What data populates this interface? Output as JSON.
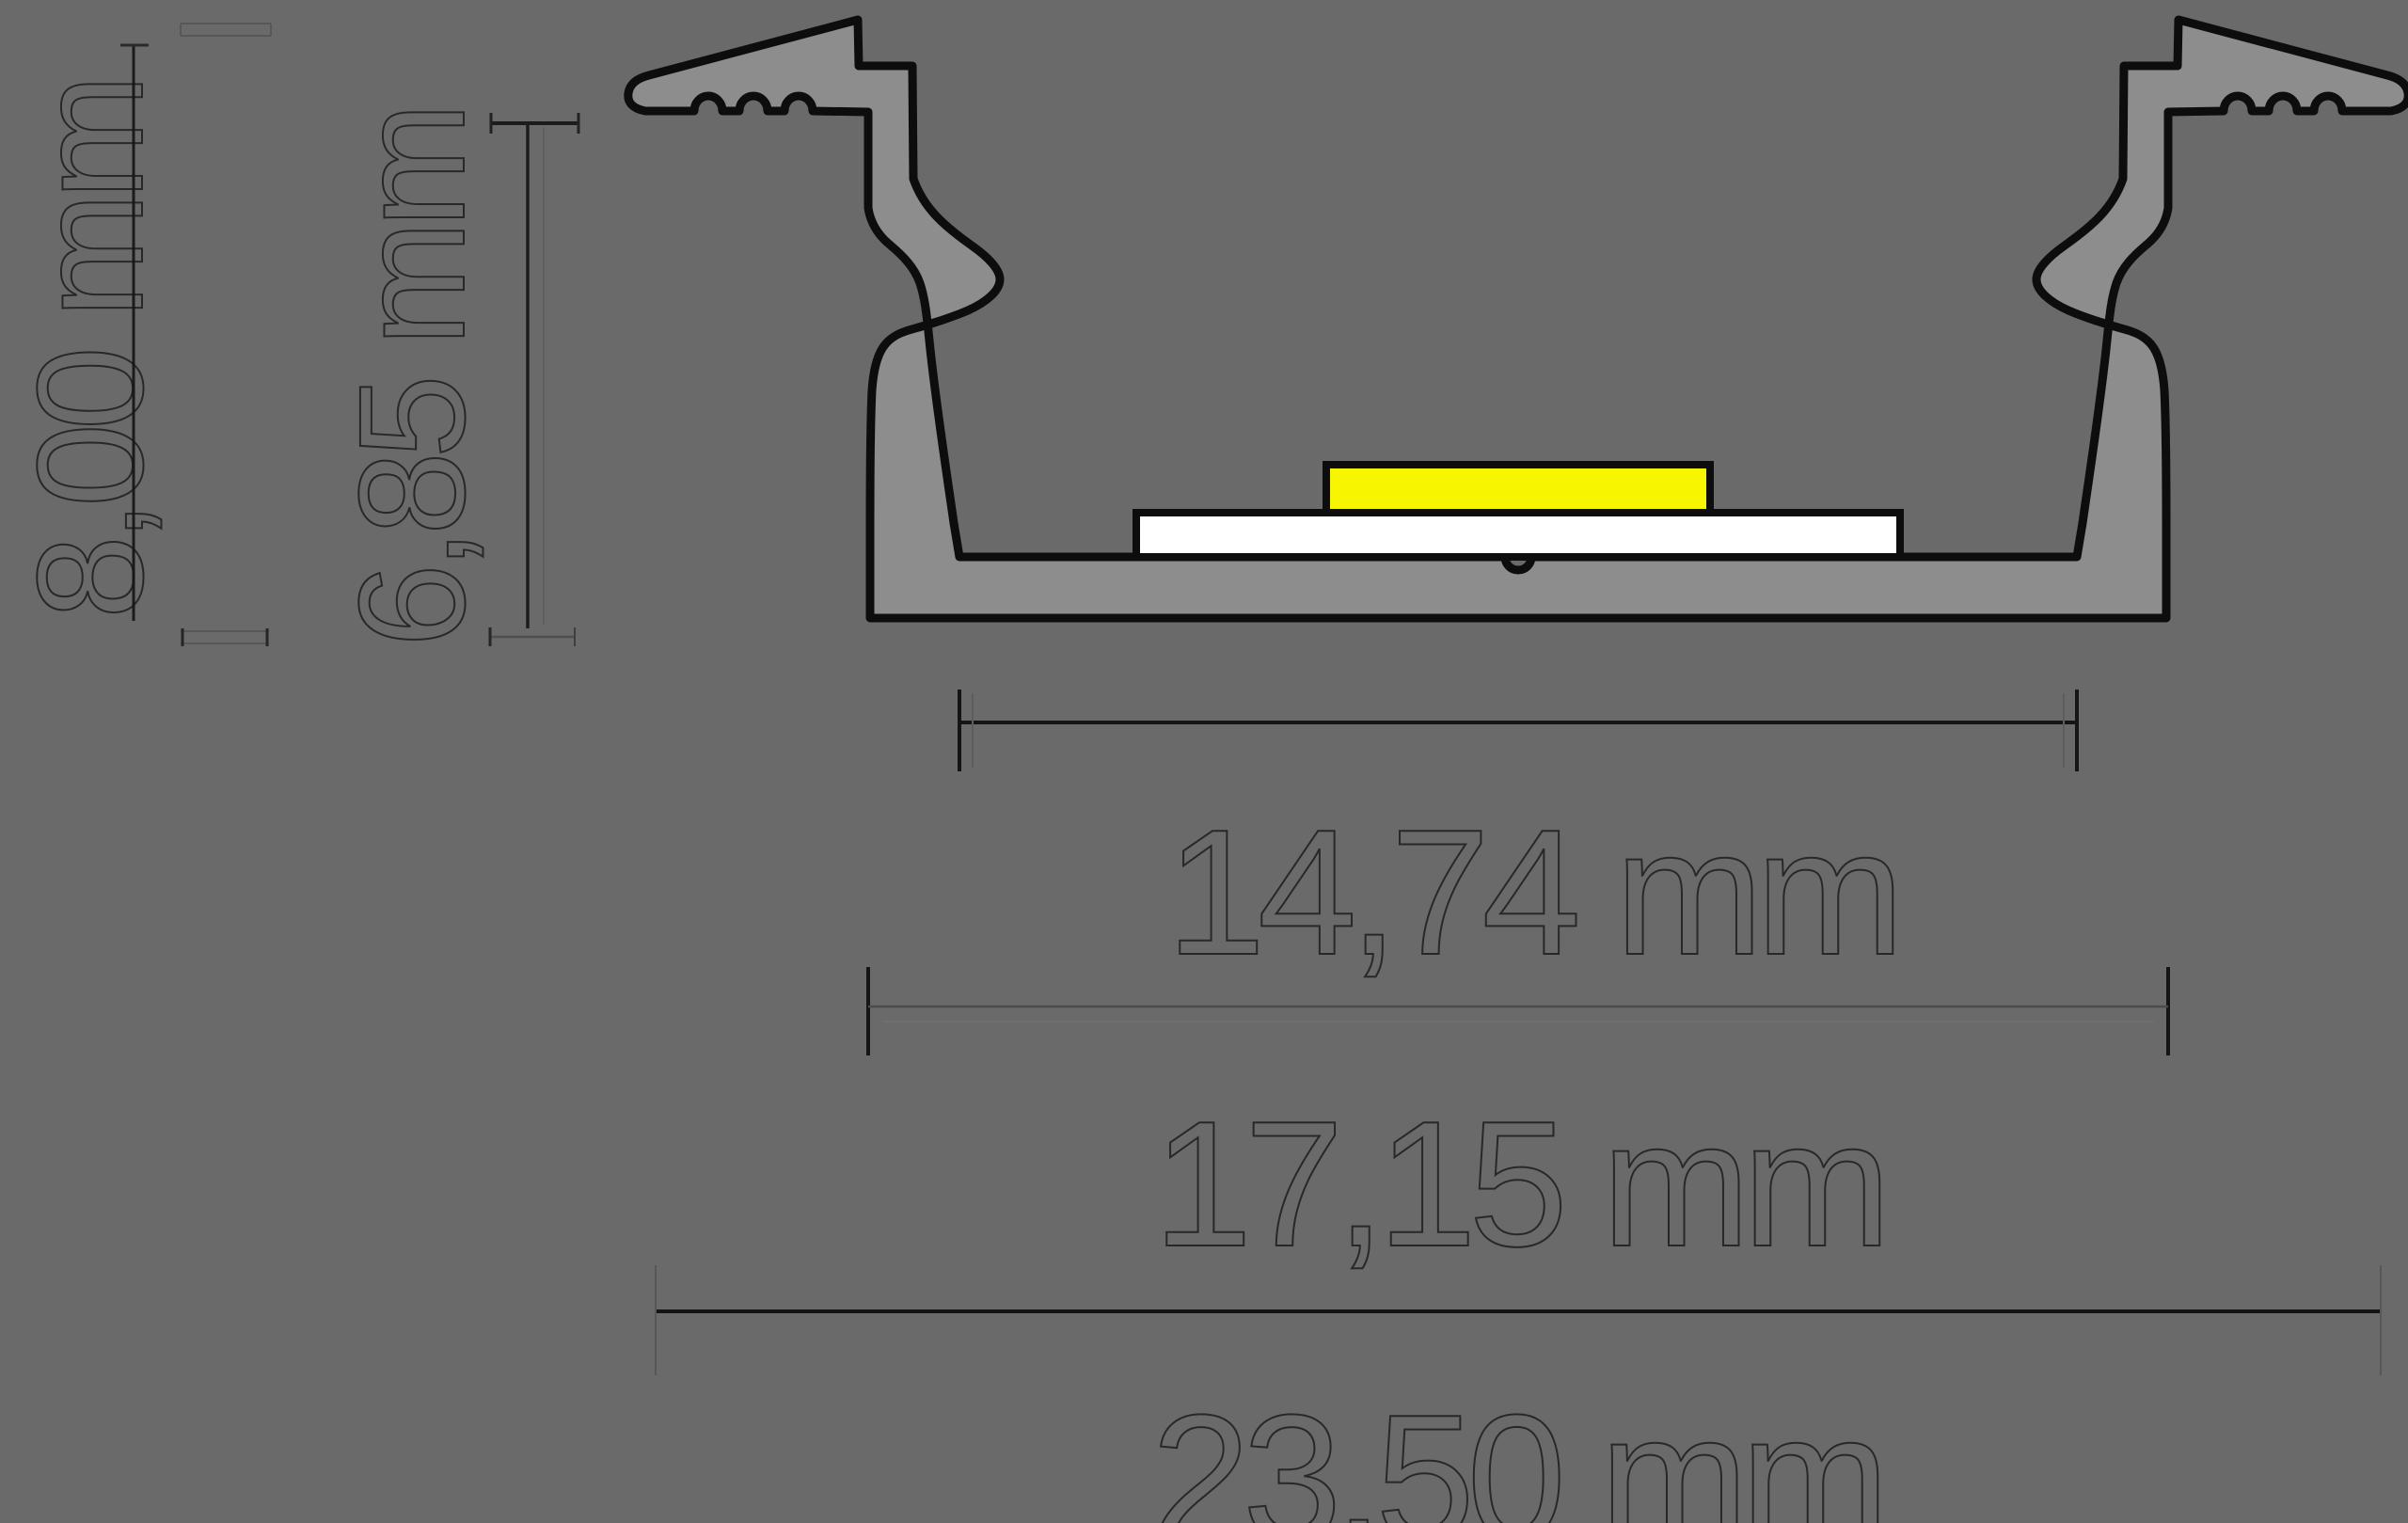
{
  "title": "LED aluminium profile cross-section drawing",
  "canvas": {
    "background": "#6a6a6a"
  },
  "profile": {
    "body_fill": "#8d8d8d",
    "outline_color": "#0d0d0d",
    "pcb_fill": "#ffffff",
    "led_fill": "#f7f500"
  },
  "dimension_labels": {
    "height_total": "8,00 mm",
    "depth_inner": "6,85 mm",
    "width_opening": "14,74 mm",
    "width_base": "17,15 mm",
    "width_total": "23,50 mm"
  }
}
